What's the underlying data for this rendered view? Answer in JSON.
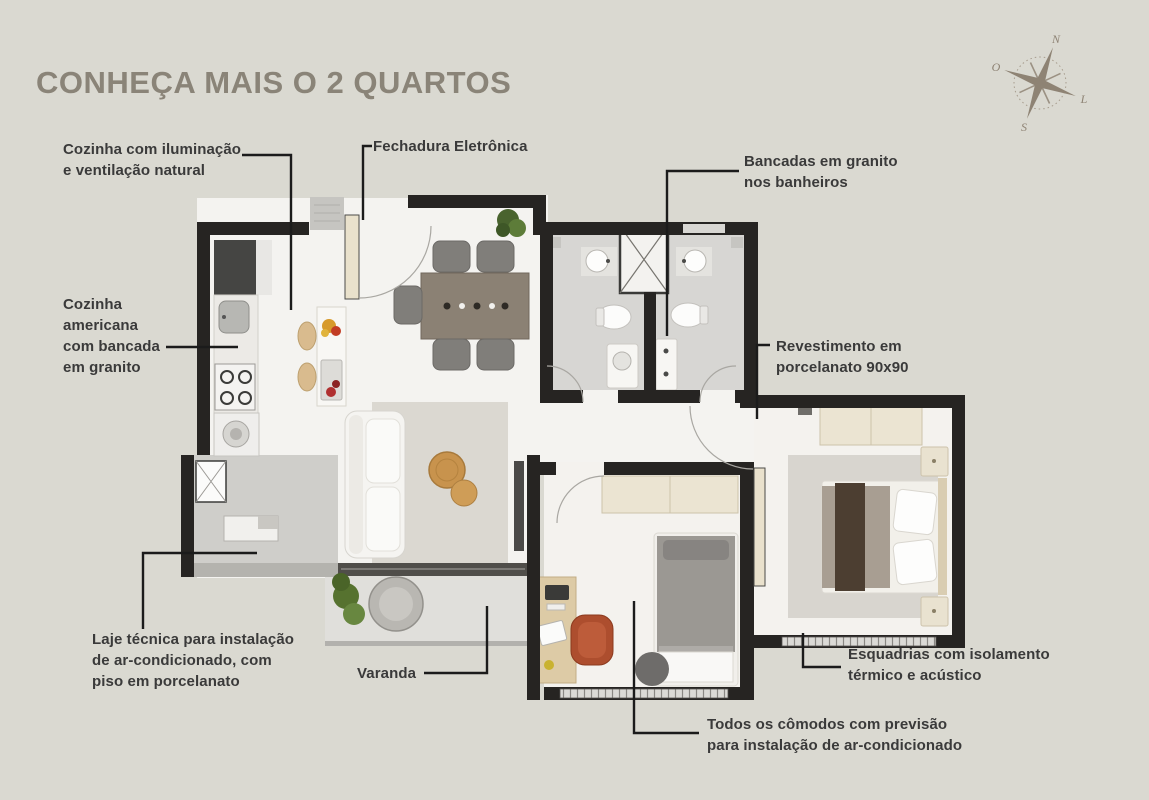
{
  "title": "CONHEÇA MAIS O 2 QUARTOS",
  "compass": {
    "north": "N",
    "south": "S",
    "west": "O",
    "east": "L"
  },
  "annotations": {
    "kitchen_light": "Cozinha com iluminação\ne ventilação natural",
    "electronic_lock": "Fechadura Eletrônica",
    "granite_countertops": "Bancadas em granito\nnos banheiros",
    "american_kitchen": "Cozinha\namericana\ncom bancada\nem granito",
    "porcelain_tiles": "Revestimento em\nporcelanato 90x90",
    "technical_slab": "Laje técnica para instalação\nde ar-condicionado, com\npiso em porcelanato",
    "balcony": "Varanda",
    "window_frames": "Esquadrias com isolamento\ntérmico e acústico",
    "ac_provision": "Todos os cômodos com previsão\npara instalação de ar-condicionado"
  },
  "colors": {
    "background": "#dad9d1",
    "title": "#8a8478",
    "label": "#3a3a3a",
    "leader_line": "#1b1b1b",
    "wall": "#262422",
    "floor": "#f4f3f0",
    "wardrobe_cream": "#ebe4d2",
    "accent_chair": "#ad4e2e",
    "accent_table": "#c8934d",
    "plant_green": "#5d7c39",
    "compass": "#8e8374"
  }
}
